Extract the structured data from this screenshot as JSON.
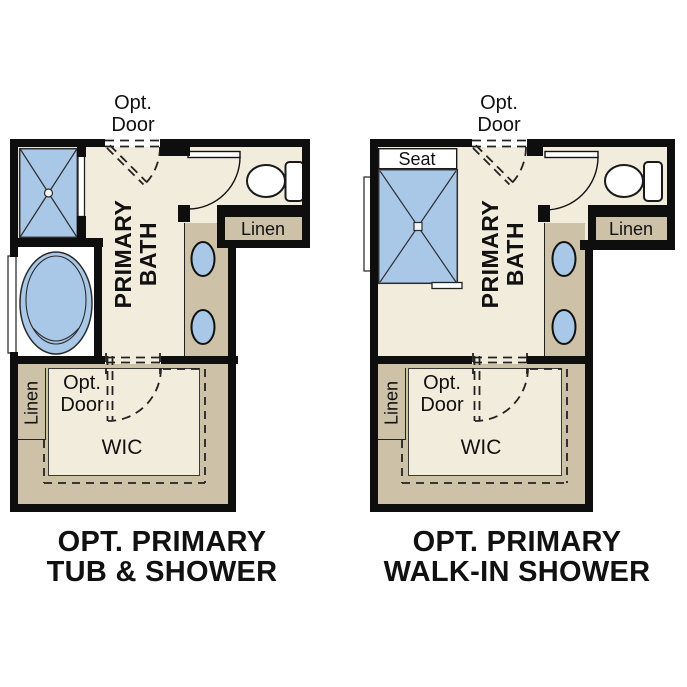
{
  "colors": {
    "wall": "#0e0e0e",
    "floor_beige": "#f2ecdc",
    "cabinet_tan": "#cdc1a7",
    "fixture_blue": "#a9c8e8",
    "background": "#ffffff",
    "text": "#111111"
  },
  "plans": [
    {
      "name": "Opt. Primary Tub & Shower",
      "caption": {
        "line1": "OPT. PRIMARY",
        "line2": "TUB & SHOWER"
      },
      "labels": {
        "opt_door_top": {
          "line1": "Opt.",
          "line2": "Door"
        },
        "primary_bath": {
          "line1": "PRIMARY",
          "line2": "BATH"
        },
        "linen_top": "Linen",
        "linen_wic": "Linen",
        "opt_door_wic": {
          "line1": "Opt.",
          "line2": "Door"
        },
        "wic": "WIC"
      }
    },
    {
      "name": "Opt. Primary Walk-In Shower",
      "caption": {
        "line1": "OPT. PRIMARY",
        "line2": "WALK-IN SHOWER"
      },
      "labels": {
        "seat": "Seat",
        "opt_door_top": {
          "line1": "Opt.",
          "line2": "Door"
        },
        "primary_bath": {
          "line1": "PRIMARY",
          "line2": "BATH"
        },
        "linen_top": "Linen",
        "linen_wic": "Linen",
        "opt_door_wic": {
          "line1": "Opt.",
          "line2": "Door"
        },
        "wic": "WIC"
      }
    }
  ]
}
